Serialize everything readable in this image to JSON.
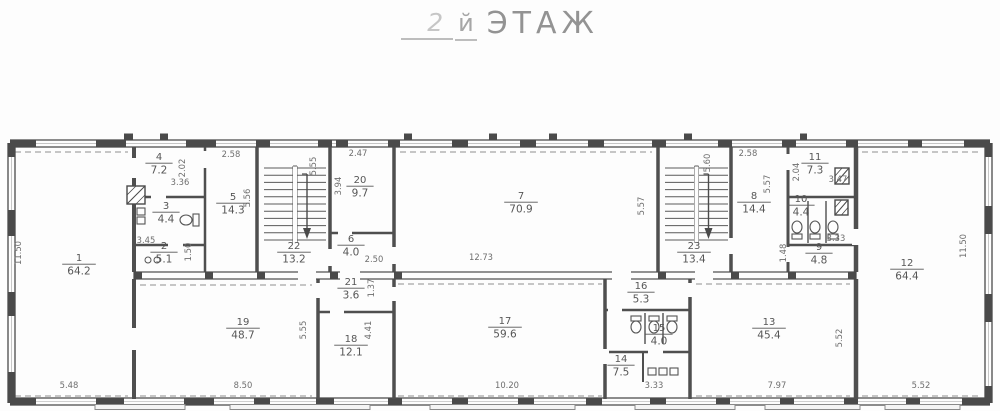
{
  "title": {
    "floor_num": "2",
    "suffix": "й",
    "word": "ЭТАЖ"
  },
  "colors": {
    "ink": "#4a4a4a",
    "wall": "#4f4f4f",
    "dash": "#8f8f8f",
    "room_text": "#565656",
    "dim_text": "#6e6e6e",
    "paper": "#fdfdfd",
    "slab_fill": "#f5f5f5"
  },
  "icons": {
    "stair_down_arrow": "arrow-down",
    "toilet_fixture": "toilet-top-view",
    "sink_fixture": "sink-top-view",
    "shaft": "hatched-square"
  },
  "plan": {
    "rooms": [
      {
        "num": "1",
        "area": "64.2",
        "x": 79,
        "y": 261
      },
      {
        "num": "2",
        "area": "5.1",
        "x": 164,
        "y": 249
      },
      {
        "num": "3",
        "area": "4.4",
        "x": 166,
        "y": 209
      },
      {
        "num": "4",
        "area": "7.2",
        "x": 159,
        "y": 160
      },
      {
        "num": "5",
        "area": "14.3",
        "x": 233,
        "y": 200
      },
      {
        "num": "6",
        "area": "4.0",
        "x": 351,
        "y": 242
      },
      {
        "num": "7",
        "area": "70.9",
        "x": 521,
        "y": 199
      },
      {
        "num": "8",
        "area": "14.4",
        "x": 754,
        "y": 199
      },
      {
        "num": "9",
        "area": "4.8",
        "x": 819,
        "y": 250
      },
      {
        "num": "10",
        "area": "4.4",
        "x": 801,
        "y": 202
      },
      {
        "num": "11",
        "area": "7.3",
        "x": 815,
        "y": 160
      },
      {
        "num": "12",
        "area": "64.4",
        "x": 907,
        "y": 266
      },
      {
        "num": "13",
        "area": "45.4",
        "x": 769,
        "y": 325
      },
      {
        "num": "14",
        "area": "7.5",
        "x": 621,
        "y": 362
      },
      {
        "num": "15",
        "area": "4.0",
        "x": 659,
        "y": 331
      },
      {
        "num": "16",
        "area": "5.3",
        "x": 641,
        "y": 289
      },
      {
        "num": "17",
        "area": "59.6",
        "x": 505,
        "y": 324
      },
      {
        "num": "18",
        "area": "12.1",
        "x": 351,
        "y": 342
      },
      {
        "num": "19",
        "area": "48.7",
        "x": 243,
        "y": 325
      },
      {
        "num": "20",
        "area": "9.7",
        "x": 360,
        "y": 183
      },
      {
        "num": "21",
        "area": "3.6",
        "x": 351,
        "y": 285
      },
      {
        "num": "22",
        "area": "13.2",
        "x": 294,
        "y": 249
      },
      {
        "num": "23",
        "area": "13.4",
        "x": 694,
        "y": 249
      }
    ],
    "dims": [
      {
        "t": "11.50",
        "x": 21,
        "y": 253,
        "r": -90
      },
      {
        "t": "5.48",
        "x": 69,
        "y": 388
      },
      {
        "t": "3.45",
        "x": 146,
        "y": 243
      },
      {
        "t": "1.50",
        "x": 191,
        "y": 252,
        "r": -90
      },
      {
        "t": "2.02",
        "x": 185,
        "y": 168,
        "r": -90
      },
      {
        "t": "3.36",
        "x": 180,
        "y": 185
      },
      {
        "t": "2.58",
        "x": 231,
        "y": 157
      },
      {
        "t": "5.56",
        "x": 250,
        "y": 198,
        "r": -90
      },
      {
        "t": "5.55",
        "x": 316,
        "y": 166,
        "r": -90
      },
      {
        "t": "2.47",
        "x": 358,
        "y": 156
      },
      {
        "t": "3.94",
        "x": 341,
        "y": 186,
        "r": -90
      },
      {
        "t": "2.50",
        "x": 374,
        "y": 262
      },
      {
        "t": "12.73",
        "x": 481,
        "y": 260
      },
      {
        "t": "5.57",
        "x": 644,
        "y": 206,
        "r": -90
      },
      {
        "t": "5.60",
        "x": 710,
        "y": 163,
        "r": -90
      },
      {
        "t": "5.57",
        "x": 770,
        "y": 184,
        "r": -90
      },
      {
        "t": "2.58",
        "x": 748,
        "y": 156
      },
      {
        "t": "2.04",
        "x": 799,
        "y": 172,
        "r": -90
      },
      {
        "t": "3.47",
        "x": 838,
        "y": 182
      },
      {
        "t": "3.33",
        "x": 836,
        "y": 241
      },
      {
        "t": "1.48",
        "x": 786,
        "y": 253,
        "r": -90
      },
      {
        "t": "11.50",
        "x": 966,
        "y": 246,
        "r": -90
      },
      {
        "t": "5.55",
        "x": 306,
        "y": 330,
        "r": -90
      },
      {
        "t": "1.37",
        "x": 374,
        "y": 288,
        "r": -90
      },
      {
        "t": "4.41",
        "x": 371,
        "y": 330,
        "r": -90
      },
      {
        "t": "8.50",
        "x": 243,
        "y": 388
      },
      {
        "t": "10.20",
        "x": 507,
        "y": 388
      },
      {
        "t": "3.33",
        "x": 654,
        "y": 388
      },
      {
        "t": "7.97",
        "x": 777,
        "y": 388
      },
      {
        "t": "5.52",
        "x": 921,
        "y": 388
      },
      {
        "t": "5.52",
        "x": 842,
        "y": 338,
        "r": -90
      }
    ]
  }
}
